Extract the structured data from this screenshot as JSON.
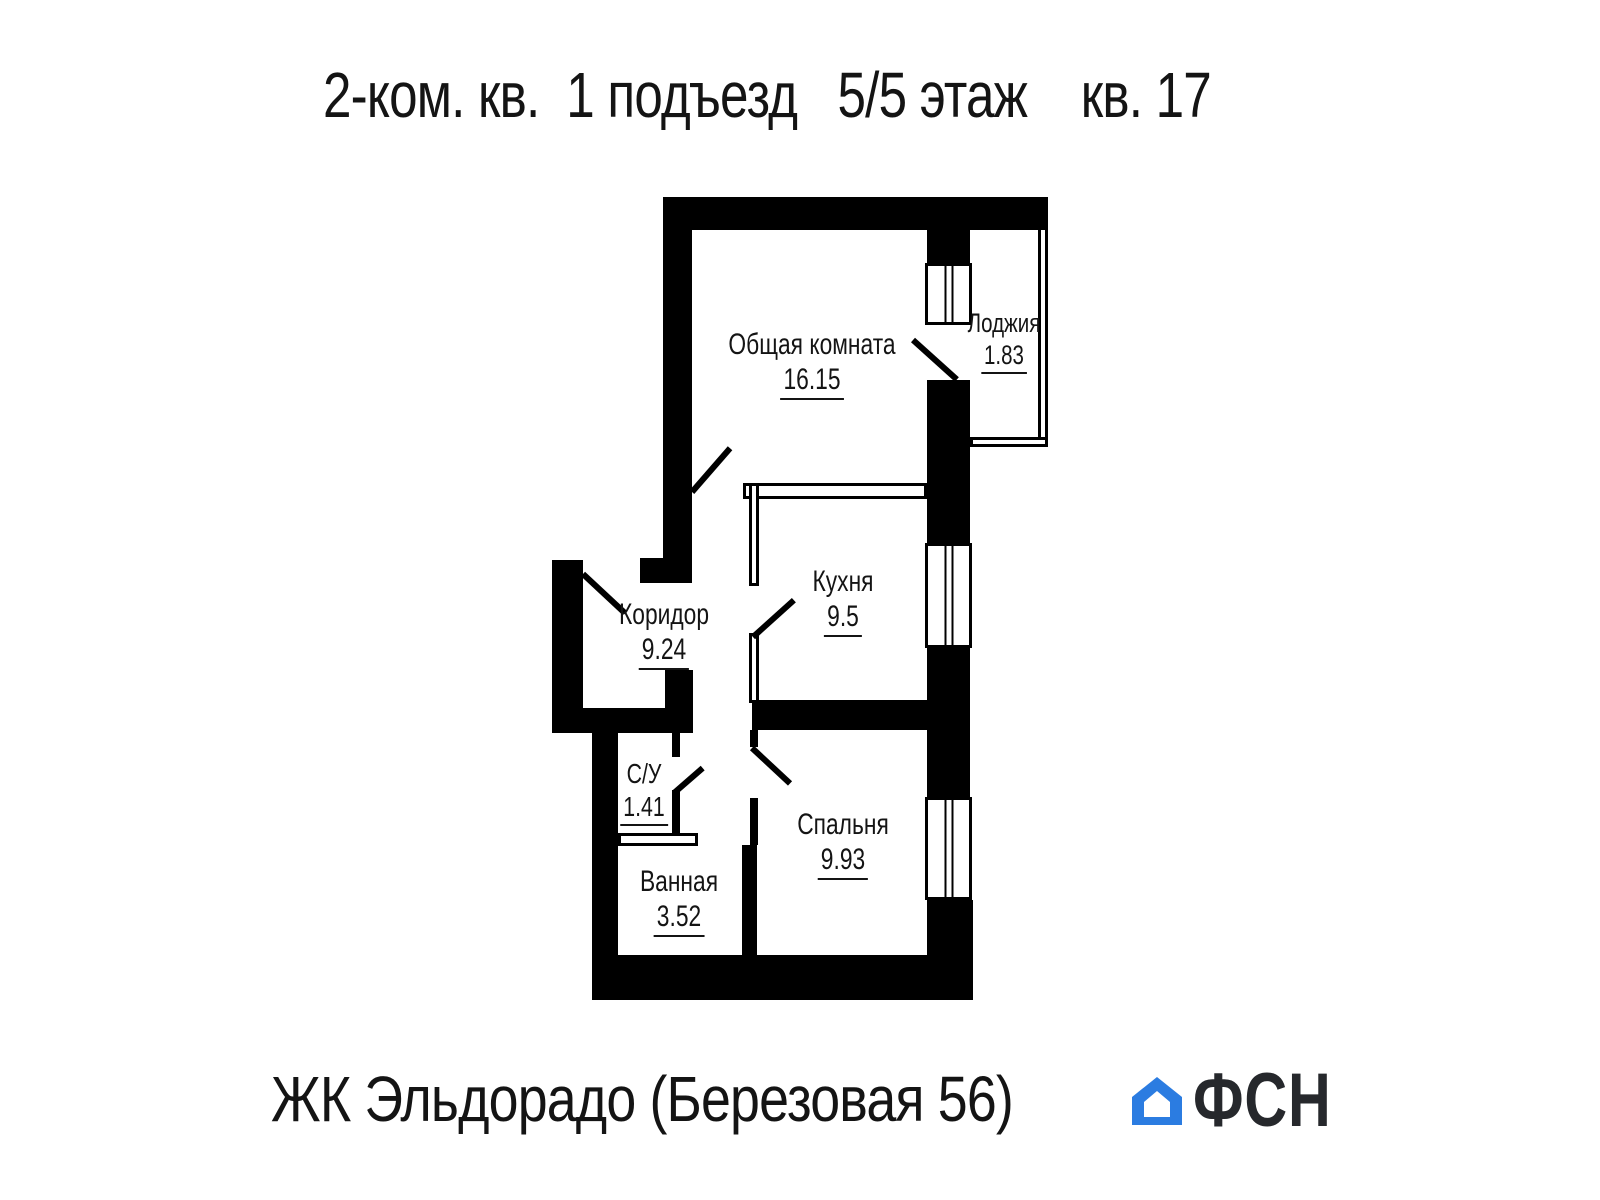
{
  "title": "2-ком. кв.  1 подъезд   5/5 этаж    кв. 17",
  "plan": {
    "rooms": [
      {
        "name": "Общая комната",
        "area": "16.15"
      },
      {
        "name": "Лоджия",
        "area": "1.83"
      },
      {
        "name": "Кухня",
        "area": "9.5"
      },
      {
        "name": "Коридор",
        "area": "9.24"
      },
      {
        "name": "С/У",
        "area": "1.41"
      },
      {
        "name": "Ванная",
        "area": "3.52"
      },
      {
        "name": "Спальня",
        "area": "9.93"
      }
    ]
  },
  "footer": {
    "project": "ЖК Эльдорадо (Березовая 56)",
    "logo": {
      "icon": "house-icon",
      "text": "ФСН",
      "blue": "#2b7ce1",
      "text_color": "#26282c"
    }
  },
  "colors": {
    "walls": "#000000",
    "background": "#ffffff",
    "text": "#141414"
  }
}
